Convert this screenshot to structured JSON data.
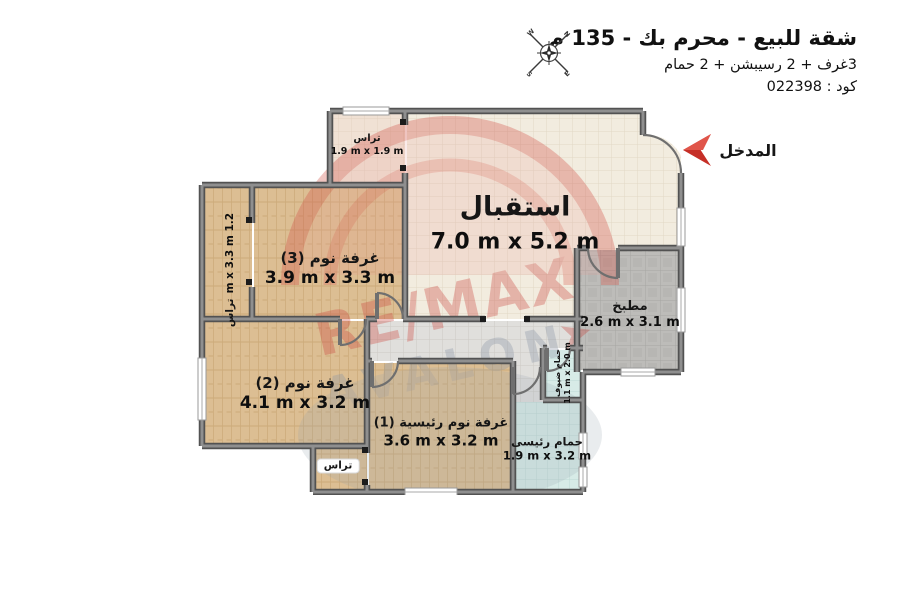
{
  "header": {
    "title": "شقة للبيع - محرم بك - 135 م",
    "subtitle": "3غرف + 2 رسيبشن + 2 حمام",
    "code": "كود : 022398"
  },
  "entrance": {
    "label": "المدخل"
  },
  "rooms": {
    "reception": {
      "name": "استقبال",
      "dims": "7.0 m x 5.2 m"
    },
    "bedroom3": {
      "name": "غرفة نوم (3)",
      "dims": "3.9 m x 3.3 m"
    },
    "bedroom2": {
      "name": "غرفة نوم (2)",
      "dims": "4.1 m x 3.2 m"
    },
    "master_bedroom": {
      "name": "غرفة نوم رئيسية (1)",
      "dims": "3.6 m x 3.2 m"
    },
    "kitchen": {
      "name": "مطبخ",
      "dims": "2.6 m x 3.1 m"
    },
    "master_bath": {
      "name": "حمام رئيسى",
      "dims": "1.9 m x 3.2 m"
    },
    "guest_bath": {
      "name": "حمام ضيوف",
      "dims": "1.1 m x 2.0 m"
    },
    "terrace_top": {
      "name": "تراس",
      "dims": "1.9 m x 1.9 m"
    },
    "terrace_left": {
      "name": "تراس",
      "dims": "1.2 m x 3.3 m"
    },
    "terrace_bottom": {
      "name": "تراس"
    }
  },
  "watermark": {
    "line1": "RE/MAX",
    "line2": "AVALON"
  },
  "colors": {
    "wall": "#6d6d6d",
    "wall_edge": "#525252",
    "accent_red": "#c62f27",
    "tile_beige": "#f2ecdf",
    "wood": "#dcbe93",
    "kitchen_gray": "#bdbcb9",
    "bath_blue": "#d7ebe7",
    "hall_gray": "#e0dfdc",
    "watermark_red": "#cc4840",
    "watermark_gray": "#8b96a5"
  }
}
